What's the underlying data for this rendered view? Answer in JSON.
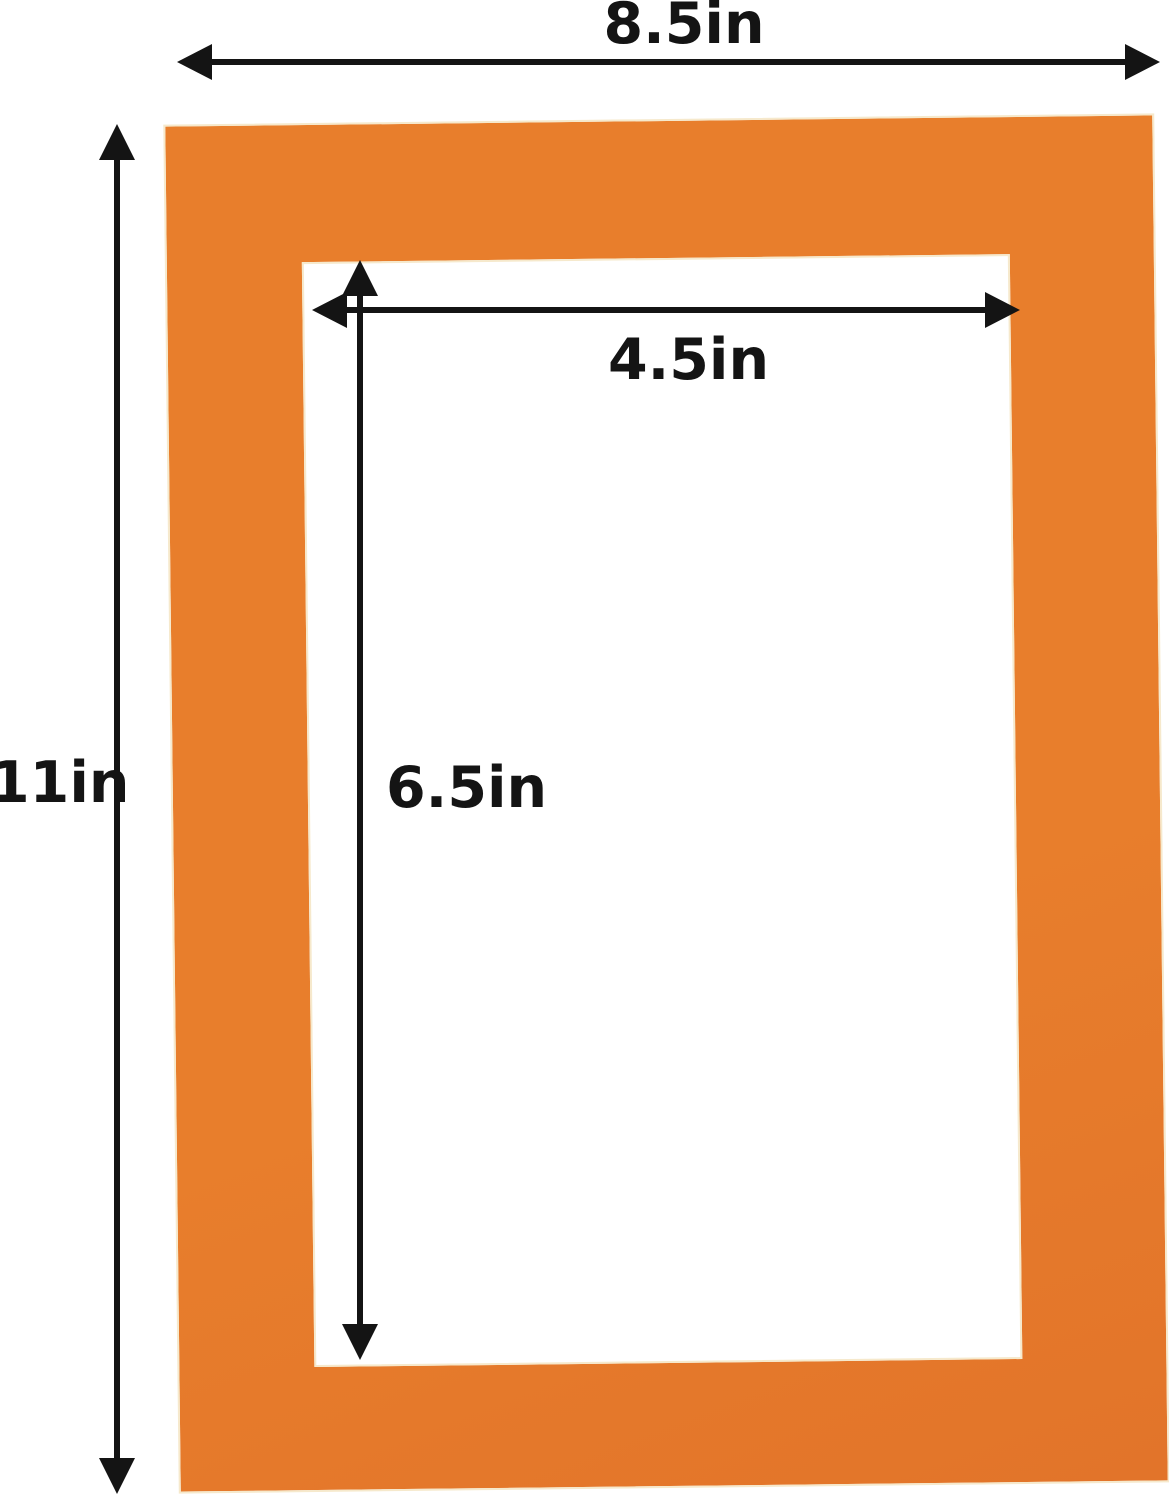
{
  "diagram": {
    "description": "Dimension diagram of an orange picture-frame mat board with a rectangular window opening",
    "labels": {
      "outer_width": "8.5in",
      "outer_height": "11in",
      "inner_width": "4.5in",
      "inner_height": "6.5in"
    },
    "colors": {
      "mat_orange": "#E87E2C",
      "mat_orange_dark": "#E2742A",
      "bevel_cream": "#F6E9CC",
      "arrow_ink": "#141414",
      "background": "#FFFFFF"
    }
  }
}
